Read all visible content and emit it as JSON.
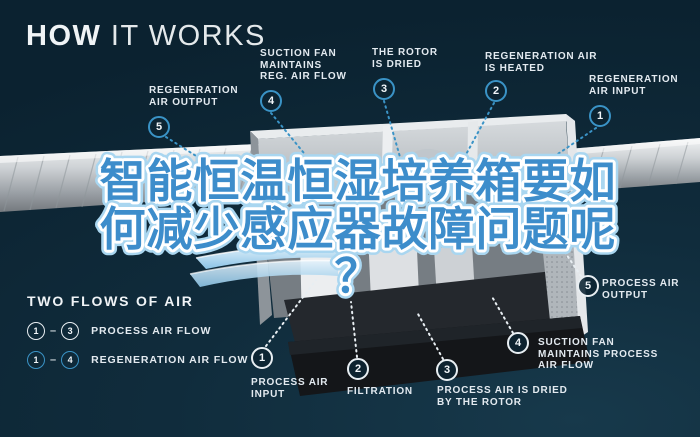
{
  "page": {
    "title_bold": "HOW",
    "title_light": " IT WORKS"
  },
  "headline": {
    "line1": "智能恒温恒湿培养箱要如",
    "line2": "何减少感应器故障问题呢",
    "line3": "？"
  },
  "legend": {
    "title": "TWO FLOWS OF AIR",
    "dash": "–",
    "rows": [
      {
        "from": "1",
        "to": "3",
        "label": "PROCESS AIR FLOW"
      },
      {
        "from": "1",
        "to": "4",
        "label": "REGENERATION AIR FLOW"
      }
    ]
  },
  "callouts": {
    "top4": {
      "num": "4",
      "line1": "SUCTION FAN",
      "line2": "MAINTAINS",
      "line3": "REG. AIR FLOW"
    },
    "top3": {
      "num": "3",
      "line1": "THE ROTOR",
      "line2": "IS DRIED"
    },
    "top2": {
      "num": "2",
      "line1": "REGENERATION AIR",
      "line2": "IS HEATED"
    },
    "top1": {
      "num": "1",
      "line1": "REGENERATION",
      "line2": "AIR INPUT"
    },
    "left5": {
      "num": "5",
      "line1": "REGENERATION",
      "line2": "AIR OUTPUT"
    },
    "bottom1": {
      "num": "1",
      "line1": "PROCESS AIR",
      "line2": "INPUT"
    },
    "bottom2": {
      "num": "2",
      "line1": "FILTRATION"
    },
    "bottom3": {
      "num": "3",
      "line1": "PROCESS AIR IS DRIED",
      "line2": "BY THE ROTOR"
    },
    "bottom4": {
      "num": "4",
      "line1": "SUCTION FAN",
      "line2": "MAINTAINS PROCESS",
      "line3": "AIR FLOW"
    },
    "right5": {
      "num": "5",
      "line1": "PROCESS AIR",
      "line2": "OUTPUT"
    }
  },
  "colors": {
    "background": "#0e2a39",
    "badge_blue": "#3a93c6",
    "badge_white": "#e8eef2",
    "headline_fill": "#3d8dcb",
    "headline_outline": "#ffffff",
    "headline_halo": "#a9d6f0"
  }
}
